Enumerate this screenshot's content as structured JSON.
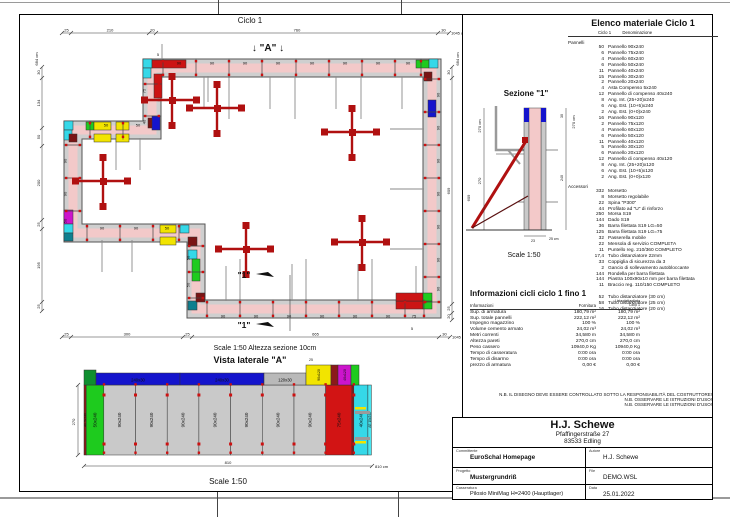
{
  "palette": {
    "wall_pink": "#f3c9c9",
    "panel_gray": "#cfcfcf",
    "red": "#cc1414",
    "maroon": "#7a1414",
    "cyan": "#35d8e8",
    "teal": "#0e7f8f",
    "green": "#1ecb1e",
    "yellow": "#f2e400",
    "blue": "#1414cc",
    "magenta": "#cc14cc",
    "dim": "#333333"
  },
  "sheet": {
    "plan": {
      "title": "Ciclo 1",
      "marker_a": "↓ \"A\" ↓",
      "cut_marker": "\"1\"",
      "small_labels": [
        "5",
        "5"
      ],
      "dims": {
        "top": [
          "25",
          "210",
          "20",
          "760",
          "30"
        ],
        "top_total": "1045 cm",
        "bottom": [
          "25",
          "300",
          "25",
          "665",
          "30"
        ],
        "bottom_total": "1045 cm",
        "left": [
          "30",
          "134",
          "50",
          "200",
          "25",
          "195",
          "25"
        ],
        "left_total": "684 cm",
        "right": [
          "30",
          "609",
          "25",
          "20"
        ],
        "right_total": "684 cm"
      },
      "panel_runs": {
        "top": [
          "90",
          "90",
          "90",
          "90",
          "90",
          "90",
          "90",
          "90"
        ],
        "right": [
          "90",
          "90",
          "90",
          "90",
          "90",
          "90",
          "90"
        ],
        "bottom": [
          "90",
          "90",
          "90",
          "90",
          "90",
          "90",
          "75"
        ],
        "left_upper": [
          "50",
          "50"
        ],
        "left_mid": [
          "90",
          "90",
          "50"
        ],
        "lower_horiz": [
          "90",
          "90",
          "50"
        ],
        "upper_vert": [
          "75",
          "40"
        ],
        "lower_vert": [
          "50",
          "50"
        ]
      }
    },
    "section": {
      "title": "Sezione \"1\"",
      "scale": "Scale 1:50",
      "dim_left_total": "270 cm",
      "dim_left": "270",
      "dim_left_outer": "609",
      "dim_right_total": "270 cm",
      "dim_right_top": "30",
      "dim_right_main": "240",
      "dim_bottom_a": "23",
      "dim_bottom_b": "25 cm"
    },
    "side_view": {
      "caption_above": "Scale 1:50   Altezza sezione 10cm",
      "title": "Vista laterale \"A\"",
      "scale": "Scale 1:50",
      "dim_height": "270",
      "dim_width": "810",
      "dim_width_unit": "810 cm",
      "dim_top": "25",
      "top_panels": [
        "240x30",
        "240x30",
        "120x30",
        "90x120",
        "40x120"
      ],
      "bottom_panels": [
        "AE 5x240",
        "50x240",
        "90x240",
        "90x240",
        "90x240",
        "90x240",
        "90x240",
        "90x240",
        "90x240",
        "75x240",
        "40x240",
        "AE 10x240"
      ]
    },
    "material_list": {
      "title": "Elenco materiale  Ciclo 1",
      "header_count": "Ciclo 1",
      "header_name": "Denominazione",
      "groups": [
        {
          "name": "Pannelli",
          "items": [
            [
              "50",
              "Pannello  90x240"
            ],
            [
              "6",
              "Pannello  75x240"
            ],
            [
              "4",
              "Pannello  60x240"
            ],
            [
              "6",
              "Pannello  50x240"
            ],
            [
              "11",
              "Pannello  40x240"
            ],
            [
              "15",
              "Pannello  30x240"
            ],
            [
              "2",
              "Pannello  20x240"
            ],
            [
              "4",
              "Asta Compenso  5x240"
            ],
            [
              "12",
              "Pannello di compenso 40x240"
            ],
            [
              "8",
              "Ang. Int. (25+20)x240"
            ],
            [
              "6",
              "Ang. Est. (10+5)x240"
            ],
            [
              "2",
              "Ang. Est. (0+0)x240"
            ],
            [
              "16",
              "Pannello  90x120"
            ],
            [
              "2",
              "Pannello  75x120"
            ],
            [
              "4",
              "Pannello  60x120"
            ],
            [
              "6",
              "Pannello  50x120"
            ],
            [
              "11",
              "Pannello  40x120"
            ],
            [
              "5",
              "Pannello  30x120"
            ],
            [
              "6",
              "Pannello  20x120"
            ],
            [
              "12",
              "Pannello di compenso 40x120"
            ],
            [
              "8",
              "Ang. Int. (25+20)x120"
            ],
            [
              "6",
              "Ang. Est. (10+5)x120"
            ],
            [
              "2",
              "Ang. Est. (0+0)x120"
            ]
          ]
        },
        {
          "name": "Accessori",
          "items": [
            [
              "332",
              "Morsetto"
            ],
            [
              "8",
              "Morsetto regolabile"
            ],
            [
              "22",
              "Spina \"P300\""
            ],
            [
              "44",
              "Profilato ad \"U\" di rinforzo"
            ],
            [
              "250",
              "Morsa S19"
            ],
            [
              "144",
              "Dado S19"
            ],
            [
              "36",
              "Barra filettata S19 LG=50"
            ],
            [
              "125",
              "Barra filettata S19 LG=75"
            ],
            [
              "32",
              "Passerella mobile"
            ],
            [
              "22",
              "Mensola di servizio COMPLETA"
            ],
            [
              "11",
              "Puntello reg. 210/360 COMPLETO"
            ],
            [
              "17,4",
              "Tubo distanziatore 22mm"
            ],
            [
              "33",
              "Coppiglia di sicurezza da 3"
            ],
            [
              "2",
              "Gancio di sollevamento autobloccante"
            ],
            [
              "144",
              "Rondella per barra filettata"
            ],
            [
              "144",
              "Piastra 100x90x10 mm per barra filettata"
            ],
            [
              "11",
              "Braccio reg. 110/150 COMPLETO"
            ]
          ]
        },
        {
          "name": "",
          "items": [
            [
              "52",
              "Tubo distanziatore  (30 cm)"
            ],
            [
              "58",
              "Tubo distanziatore  (25 cm)"
            ],
            [
              "16",
              "Tubo distanziatore  (20 cm)"
            ]
          ]
        }
      ]
    },
    "info_table": {
      "title": "Informazioni cicli  ciclo 1 fino 1",
      "col1": "Informazioni",
      "col2": "Fornitura",
      "col3a": "Lista dettagliata",
      "col3b": "Ciclo 1",
      "rows": [
        [
          "Sup. di armatura",
          "180,79 m²",
          "180,79 m²"
        ],
        [
          "Sup. totale pannelli",
          "222,12 m²",
          "222,12 m²"
        ],
        [
          "Impegno magazzino",
          "100 %",
          "100 %"
        ],
        [
          "Volume cemento armato",
          "24,02 m³",
          "24,02 m³"
        ],
        [
          "Metri correnti",
          "34,580 m",
          "34,580 m"
        ],
        [
          "Altezza pareti",
          "270,0 cm",
          "270,0 cm"
        ],
        [
          "Peso cassero",
          "10940,0 Kg",
          "10940,0 Kg"
        ],
        [
          "Tempo di casseratura",
          "0:00 ora",
          "0:00 ora"
        ],
        [
          "Tempo di disarmo",
          "0:00 ora",
          "0:00 ora"
        ],
        [
          "prezzo di armatura",
          "0,00 €",
          "0,00 €"
        ]
      ]
    },
    "notes": [
      "N.B. IL DISEGNO DEVE ESSERE CONTROLLATO SOTTO LA RESPONSABILITÀ DEL COSTRUTTORE!",
      "N.B. OSSERVARE LE ISTRUZIONI D'USO!",
      "N.B. OSSERVARE LE ISTRUZIONI D'USO!"
    ],
    "title_block": {
      "company": "H.J. Schewe",
      "address1": "Pfaffingerstraße 27",
      "address2": "83533 Edling",
      "committente_label": "Committente",
      "committente": "EuroSchal Homepage",
      "autore_label": "Autore",
      "autore": "H.J. Schewe",
      "progetto_label": "Progetto",
      "progetto": "Mustergrundriß",
      "file_label": "File",
      "file": "DEMO.WSL",
      "casseratura_label": "Casseratura",
      "casseratura": "Pilosio MiniMag H=2400 (Hauptlager)",
      "data_label": "Data",
      "data_value": "25.01.2022"
    }
  }
}
